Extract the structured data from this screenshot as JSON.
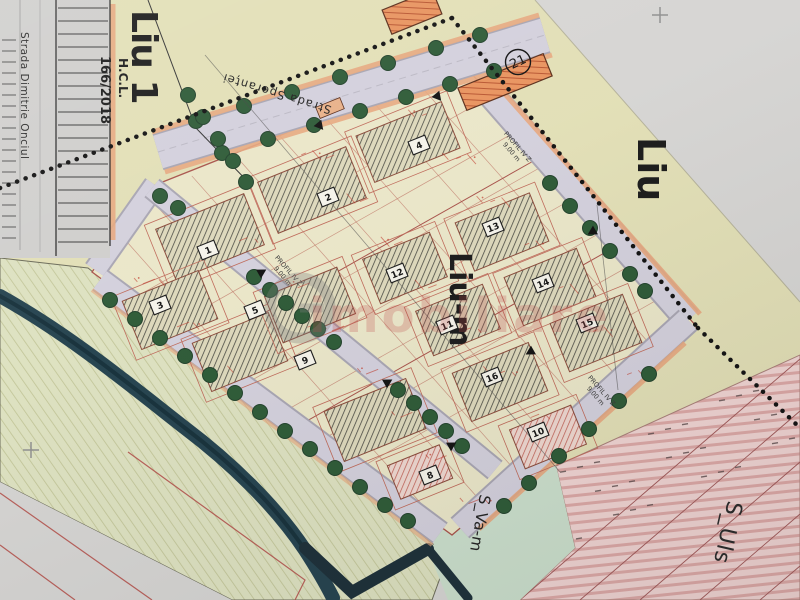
{
  "map": {
    "zones": {
      "liu1_label": "Liu 1",
      "liu1_sub1": "H.C.L.",
      "liu1_sub2": "166/2018",
      "liu_label": "Liu",
      "lium_label": "Liu-m",
      "suls_label": "S_Uls",
      "svam_label": "S_Va-m"
    },
    "parcel_badge": "21",
    "streets": {
      "onciul": "Strada Dimitrie Onciul",
      "sperantei": "Strada Speranței"
    },
    "profile_label": "PROFIL IV Z",
    "profile_width": "9.00 m",
    "watermark": "imobiliare",
    "plots": [
      {
        "num": "1",
        "x": 208,
        "y": 250
      },
      {
        "num": "2",
        "x": 328,
        "y": 197
      },
      {
        "num": "3",
        "x": 160,
        "y": 305
      },
      {
        "num": "4",
        "x": 419,
        "y": 145
      },
      {
        "num": "5",
        "x": 255,
        "y": 310
      },
      {
        "num": "9",
        "x": 305,
        "y": 360
      },
      {
        "num": "12",
        "x": 397,
        "y": 273
      },
      {
        "num": "11",
        "x": 447,
        "y": 325
      },
      {
        "num": "13",
        "x": 493,
        "y": 227
      },
      {
        "num": "14",
        "x": 543,
        "y": 283
      },
      {
        "num": "15",
        "x": 587,
        "y": 323
      },
      {
        "num": "16",
        "x": 492,
        "y": 377
      },
      {
        "num": "8",
        "x": 430,
        "y": 475
      },
      {
        "num": "10",
        "x": 538,
        "y": 432
      }
    ],
    "colors": {
      "zone_khaki": "#e2dfb6",
      "zone_pink": "#f0d4d2",
      "zone_green": "#dde1c0",
      "zone_mint": "#cbdfcc",
      "street": "#d3d0dc",
      "tree": "#2d5a36",
      "annotation_red": "#c0392b"
    }
  }
}
